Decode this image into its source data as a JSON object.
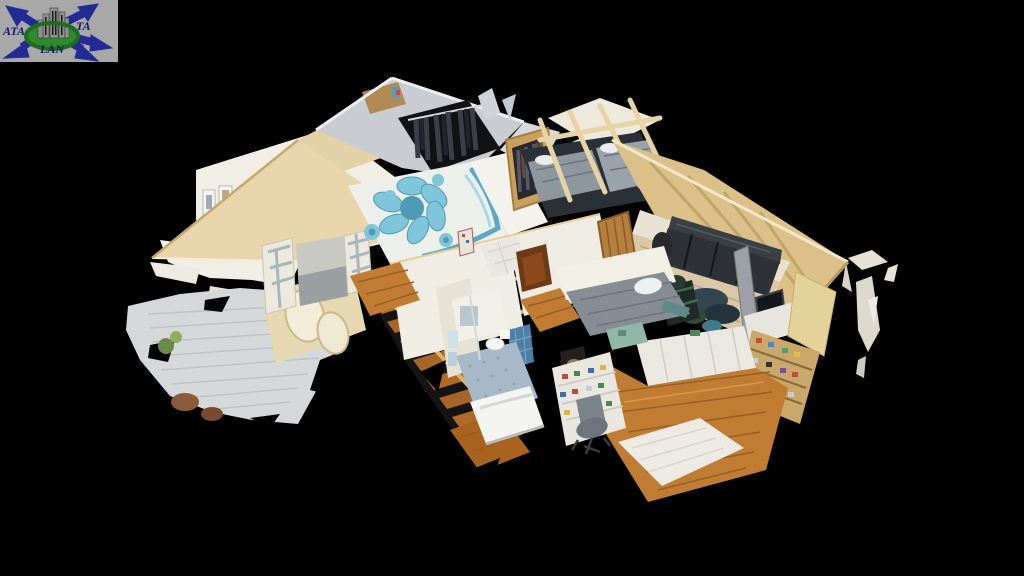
{
  "scene": {
    "type": "dollhouse-3d-model",
    "description": "Cutaway dollhouse view of a scanned attic apartment floating on a black background"
  },
  "logo": {
    "text_left": "ATA",
    "text_right": "TA",
    "text_bottom": "LAN",
    "bg": "#a8a8a8",
    "arrow_color": "#232a94",
    "ring_color": "#2e8b2e",
    "building_color": "#919191",
    "text_color": "#16166a"
  },
  "palette": {
    "bg": "#000000",
    "roof_cream": "#e8d5ab",
    "roof_gold": "#dcc089",
    "roof_gray": "#c9cdd2",
    "roof_edge": "#c2a368",
    "wall_white": "#f1eee6",
    "wall_cream": "#e6d9b2",
    "wood": "#c07c32",
    "wood_dark": "#9a5f22",
    "wood_light": "#d9c7a5",
    "deck": "#d5d8d9",
    "deck_line": "#bfc3c5",
    "rug_white": "#edf0ea",
    "rug_blue": "#7fc6da",
    "rug_blue_dark": "#4f9ab5",
    "sofa_blue": "#cfe2e8",
    "bed_gray": "#8e969e",
    "couch_black": "#2e3237",
    "tile_blue": "#4e7fa6",
    "bath_floor": "#a7b9c9",
    "dark": "#141414"
  }
}
